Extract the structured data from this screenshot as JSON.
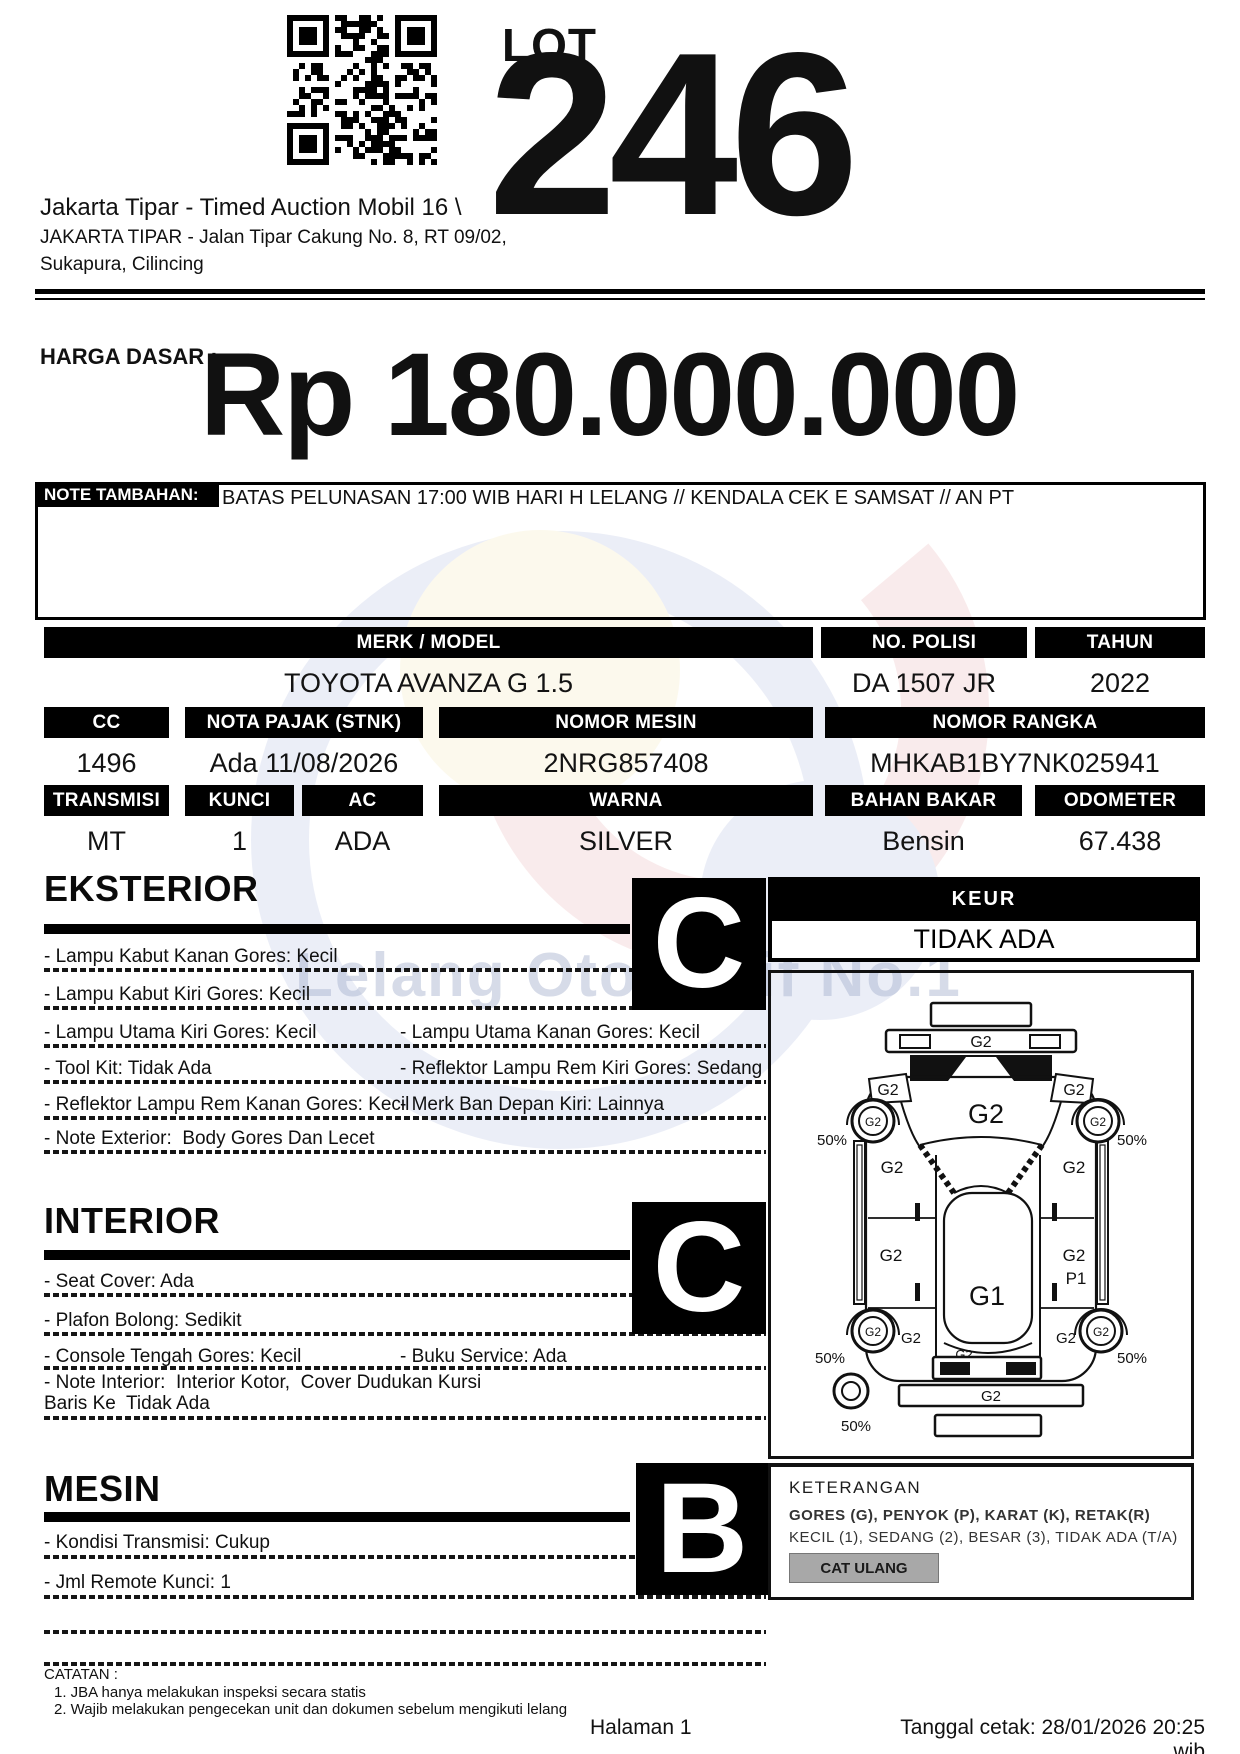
{
  "header": {
    "lot_label": "LOT",
    "lot_number": "246",
    "auction_title": "Jakarta Tipar - Timed Auction Mobil 16 \\",
    "address_line1": "JAKARTA TIPAR - Jalan Tipar Cakung No. 8, RT 09/02,",
    "address_line2": "Sukapura, Cilincing"
  },
  "price": {
    "label": "HARGA DASAR :",
    "value": "Rp 180.000.000"
  },
  "note": {
    "label": "NOTE TAMBAHAN:",
    "text": "BATAS PELUNASAN 17:00 WIB HARI H LELANG // KENDALA CEK E SAMSAT // AN PT"
  },
  "specs": {
    "row1": [
      {
        "label": "MERK / MODEL",
        "value": "TOYOTA AVANZA G 1.5"
      },
      {
        "label": "NO. POLISI",
        "value": "DA 1507 JR"
      },
      {
        "label": "TAHUN",
        "value": "2022"
      }
    ],
    "row2": [
      {
        "label": "CC",
        "value": "1496"
      },
      {
        "label": "NOTA PAJAK (STNK)",
        "value": "Ada 11/08/2026"
      },
      {
        "label": "NOMOR MESIN",
        "value": "2NRG857408"
      },
      {
        "label": "NOMOR RANGKA",
        "value": "MHKAB1BY7NK025941"
      }
    ],
    "row3": [
      {
        "label": "TRANSMISI",
        "value": "MT"
      },
      {
        "label": "KUNCI",
        "value": "1"
      },
      {
        "label": "AC",
        "value": "ADA"
      },
      {
        "label": "WARNA",
        "value": "SILVER"
      },
      {
        "label": "BAHAN BAKAR",
        "value": "Bensin"
      },
      {
        "label": "ODOMETER",
        "value": "67.438"
      }
    ]
  },
  "sections": {
    "eksterior": {
      "title": "EKSTERIOR",
      "grade": "C",
      "rows": [
        {
          "l": "- Lampu Kabut Kanan Gores: Kecil",
          "r": ""
        },
        {
          "l": "- Lampu Kabut Kiri Gores: Kecil",
          "r": ""
        },
        {
          "l": "- Lampu Utama Kiri Gores: Kecil",
          "r": "- Lampu Utama Kanan Gores: Kecil"
        },
        {
          "l": "- Tool Kit: Tidak Ada",
          "r": "- Reflektor Lampu Rem Kiri Gores: Sedang"
        },
        {
          "l": "- Reflektor Lampu Rem Kanan Gores: Kecil",
          "r": "- Merk Ban Depan Kiri: Lainnya"
        },
        {
          "l": "- Note Exterior:  Body Gores Dan Lecet",
          "r": ""
        }
      ]
    },
    "interior": {
      "title": "INTERIOR",
      "grade": "C",
      "rows": [
        {
          "l": "- Seat Cover: Ada",
          "r": ""
        },
        {
          "l": "- Plafon Bolong: Sedikit",
          "r": ""
        },
        {
          "l": "- Console Tengah Gores: Kecil",
          "r": "- Buku Service: Ada"
        },
        {
          "l": "- Note Interior:  Interior Kotor,  Cover Dudukan Kursi Baris Ke  Tidak Ada",
          "r": ""
        }
      ]
    },
    "mesin": {
      "title": "MESIN",
      "grade": "B",
      "rows": [
        {
          "l": "- Kondisi Transmisi: Cukup",
          "r": ""
        },
        {
          "l": "- Jml Remote Kunci: 1",
          "r": ""
        }
      ]
    }
  },
  "keur": {
    "label": "KEUR",
    "value": "TIDAK ADA"
  },
  "diagram": {
    "front_plate": "",
    "front_bumper": "G2",
    "hood": "G2",
    "fender_left": "G2",
    "fender_right": "G2",
    "wheel_front_left": "G2",
    "wheel_front_right": "G2",
    "wheel_rear_left": "G2",
    "wheel_rear_right": "G2",
    "door_front_left": "G2",
    "door_front_right": "G2",
    "quarter_left": "G2",
    "quarter_right": "G2",
    "quarter_right_dent": "P1",
    "roof": "G1",
    "trunk": "G2",
    "rear_bumper": "G2",
    "side_rear_left": "G2",
    "side_rear_right": "G2",
    "pct_front_left": "50%",
    "pct_front_right": "50%",
    "pct_rear_left": "50%",
    "pct_rear_right": "50%",
    "pct_spare": "50%"
  },
  "keterangan": {
    "title": "KETERANGAN",
    "line1": "GORES (G), PENYOK (P), KARAT (K), RETAK(R)",
    "line2": "KECIL (1), SEDANG (2), BESAR (3), TIDAK ADA (T/A)",
    "button": "CAT ULANG"
  },
  "catatan": {
    "title": "CATATAN :",
    "item1": "1. JBA hanya melakukan inspeksi secara statis",
    "item2": "2. Wajib melakukan pengecekan unit dan dokumen sebelum mengikuti lelang"
  },
  "footer": {
    "page": "Halaman 1",
    "printed": "Tanggal cetak: 28/01/2026 20:25 wib"
  },
  "watermark": {
    "text": "Lelang Otomotif No.1"
  },
  "colors": {
    "bar": "#000000",
    "button_gray": "#a8a8a8"
  }
}
